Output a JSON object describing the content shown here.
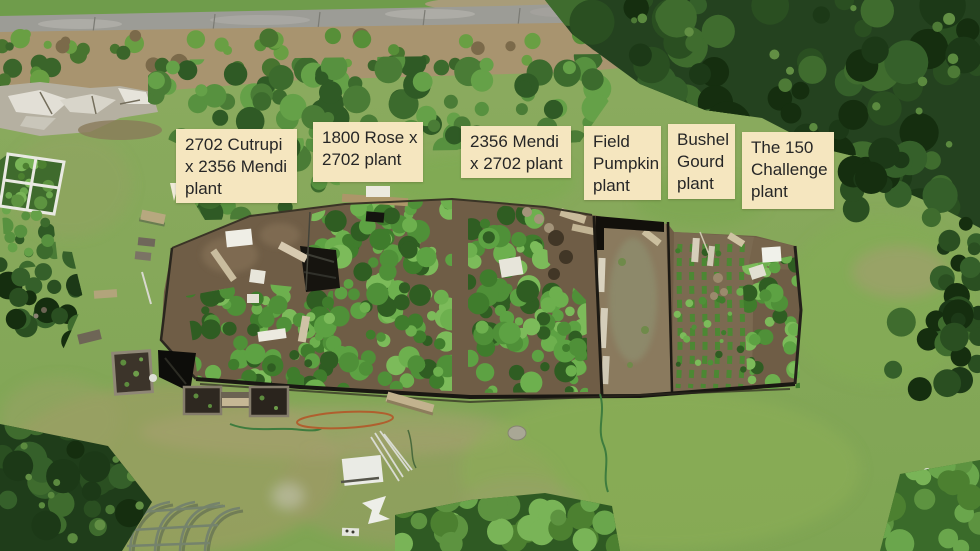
{
  "scene": {
    "description": "Aerial drone photo of a pumpkin-growing garden with six annotated plots",
    "labels": [
      {
        "id": "plot-1",
        "lines": [
          "2702 Cutrupi",
          "x 2356 Mendi",
          "plant"
        ]
      },
      {
        "id": "plot-2",
        "lines": [
          "1800 Rose x",
          "2702 plant"
        ]
      },
      {
        "id": "plot-3",
        "lines": [
          "2356 Mendi",
          "x 2702 plant"
        ]
      },
      {
        "id": "plot-4",
        "lines": [
          "Field",
          "Pumpkin",
          "plant"
        ]
      },
      {
        "id": "plot-5",
        "lines": [
          "Bushel",
          "Gourd",
          "plant"
        ]
      },
      {
        "id": "plot-6",
        "lines": [
          "The 150",
          "Challenge",
          "plant"
        ]
      }
    ],
    "colors": {
      "label_bg": "#f5e6bf",
      "label_text": "#262626",
      "lawn": "#85a45a",
      "vines": "#4f9038",
      "soil": "#6f5d46",
      "road": "#9c9c96",
      "conifer": "#24421f"
    }
  }
}
